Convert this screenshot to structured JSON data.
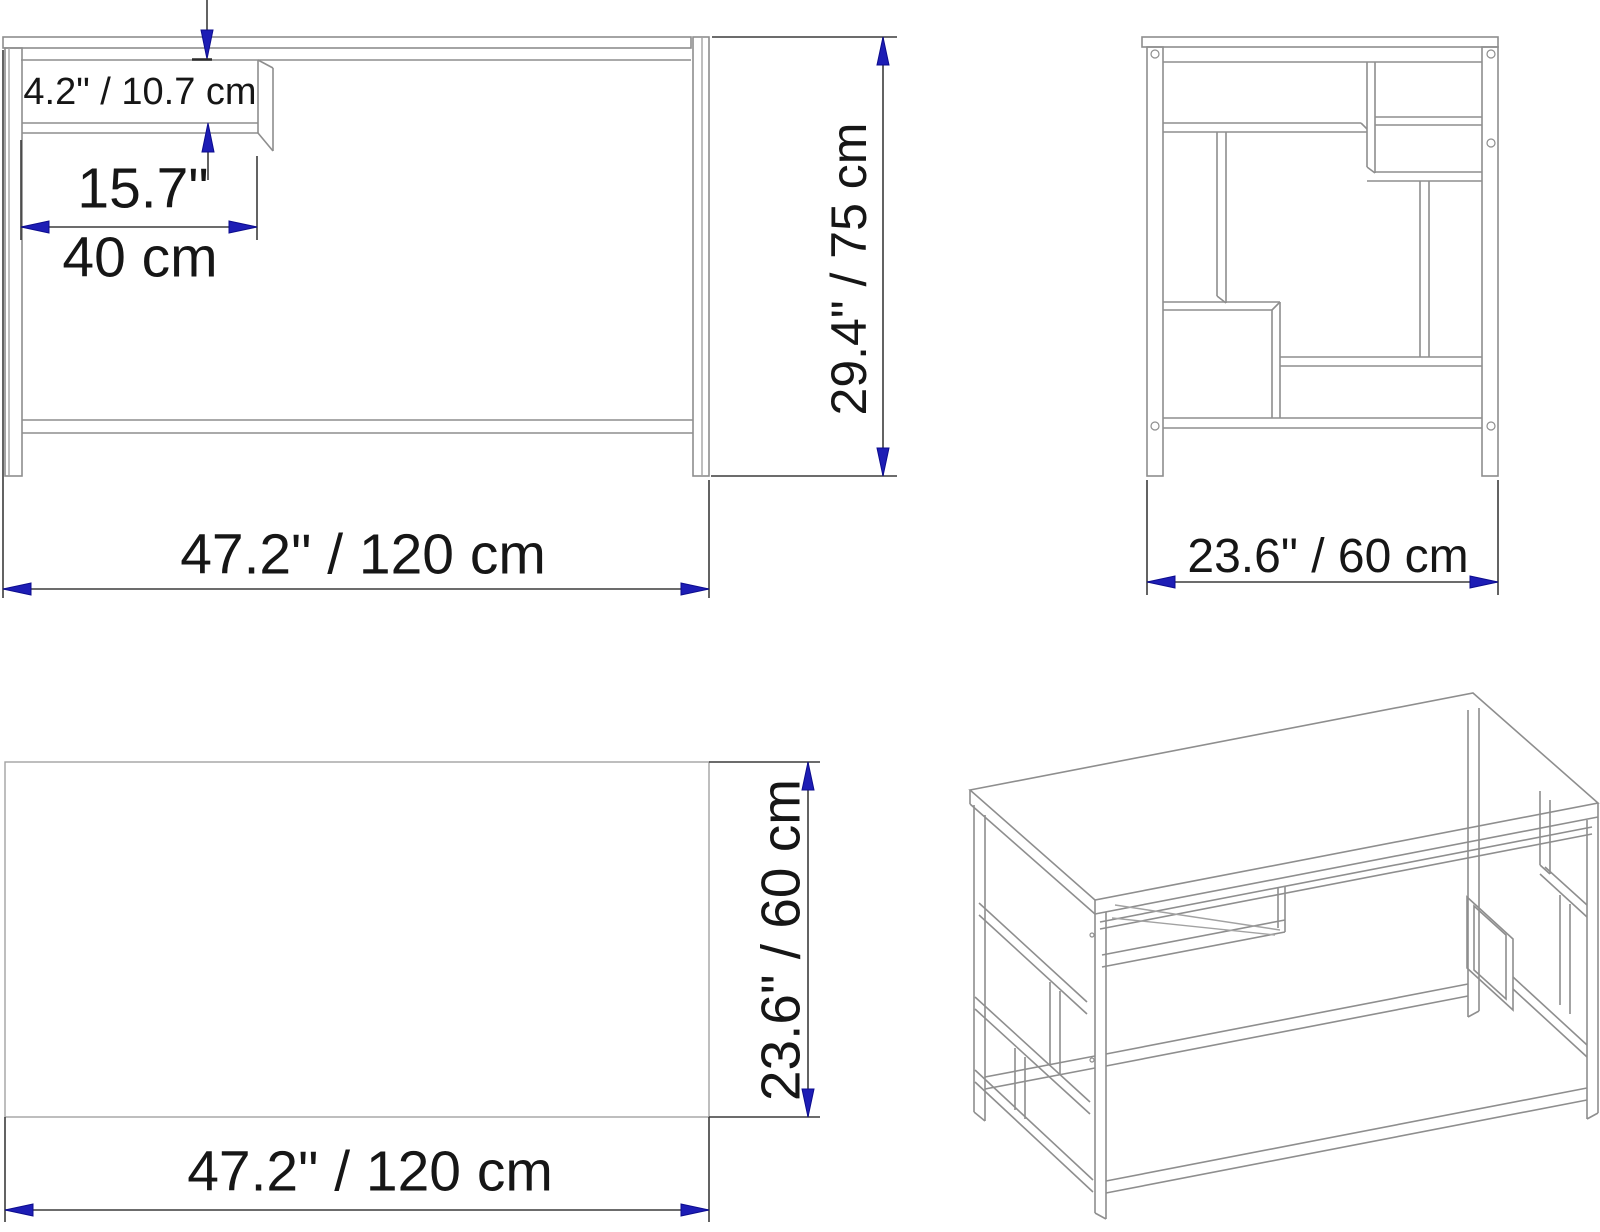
{
  "drawing": {
    "title": "Desk dimension drawing",
    "background": "#ffffff",
    "colors": {
      "arrow_fill": "#1d1db5",
      "arrow_outline": "#0c0c8e",
      "dimension_line": "#3c3c3c",
      "drawing_line": "#8e8e8e",
      "text": "#161616"
    },
    "views": {
      "front": {
        "name": "front view",
        "dimensions": {
          "shelf_gap": "4.2\" / 10.7 cm",
          "shelf_width_inches": "15.7\"",
          "shelf_width_cm": "40 cm",
          "overall_width": "47.2\" / 120 cm",
          "overall_height": "29.4\" / 75 cm"
        }
      },
      "side": {
        "name": "side view",
        "dimensions": {
          "overall_depth": "23.6\" / 60 cm"
        }
      },
      "top": {
        "name": "top view",
        "dimensions": {
          "overall_depth": "23.6\" / 60 cm",
          "overall_width": "47.2\" / 120 cm"
        }
      },
      "perspective": {
        "name": "3d perspective view"
      }
    }
  }
}
